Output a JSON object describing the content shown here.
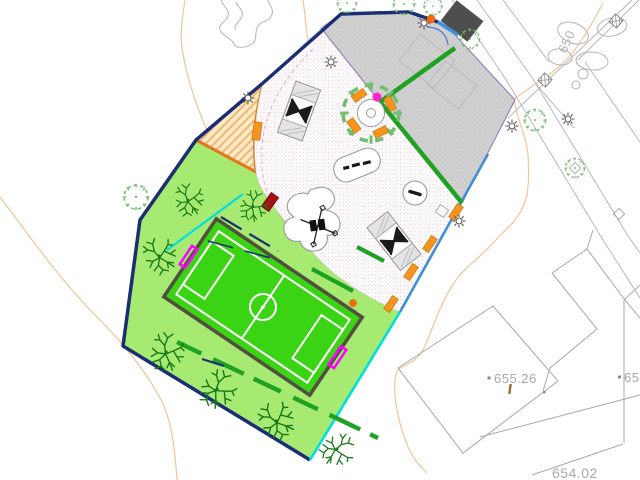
{
  "labels": {
    "contour_elevation": "650",
    "spot_elevation_a": "655.26",
    "spot_elevation_b": "654",
    "spot_elevation_c": "654.02"
  },
  "colors": {
    "site_boundary_navy": "#1b2d73",
    "lawn_green": "#a7ea72",
    "pitch_green": "#3bd414",
    "pitch_border_olive": "#50503c",
    "pitch_line_white": "#ffffff",
    "goal_magenta": "#ff00ff",
    "fence_green": "#1fa121",
    "paving_gray": "#d2d2d2",
    "sand_border_orange": "#e2761b",
    "edge_cyan": "#00dede",
    "edge_blue": "#3f8fd8",
    "bench_orange": "#f7941d",
    "bench_dark_red": "#a51414",
    "contour_peach": "#f2c496",
    "tree_green": "#157815",
    "shrub_green": "#6fbf6f",
    "road_gray": "#b2b2b2",
    "label_gray": "#a8a8a8",
    "marker_magenta": "#ff22cc",
    "marker_orange": "#ff6a00",
    "building_dark": "#4e4e4e"
  }
}
